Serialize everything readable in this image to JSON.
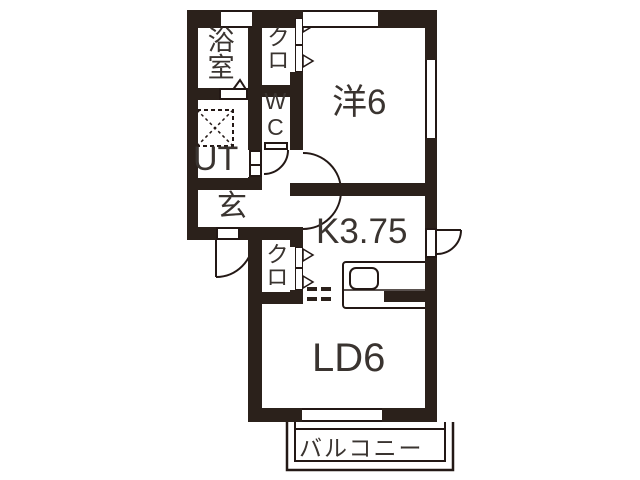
{
  "plan": {
    "type": "apartment-floor-plan",
    "rooms": {
      "bathroom": {
        "label": "浴室"
      },
      "closet_top": {
        "label": "クロ"
      },
      "toilet": {
        "label": "WC"
      },
      "utility": {
        "label": "UT"
      },
      "entrance": {
        "label": "玄"
      },
      "western_room": {
        "label": "洋6"
      },
      "kitchen": {
        "label": "K3.75"
      },
      "closet_kitchen": {
        "label": "クロ"
      },
      "living_dining": {
        "label": "LD6"
      },
      "balcony": {
        "label": "バルコニー"
      }
    },
    "colors": {
      "wall": "#2b211b",
      "line": "#231815",
      "background": "#ffffff",
      "text": "#3a3430"
    },
    "markers": {
      "door_swing": "quarter-circle-arc",
      "hall_door_swing": "half-circle-arc",
      "closet_door": "right-pointing-triangles",
      "washing_machine_pan": "dashed-square-with-x",
      "bath_door": "up-caret-triangle",
      "kitchen_counter": "sink-and-stove",
      "open_boundary": "double-dashed-line"
    }
  }
}
